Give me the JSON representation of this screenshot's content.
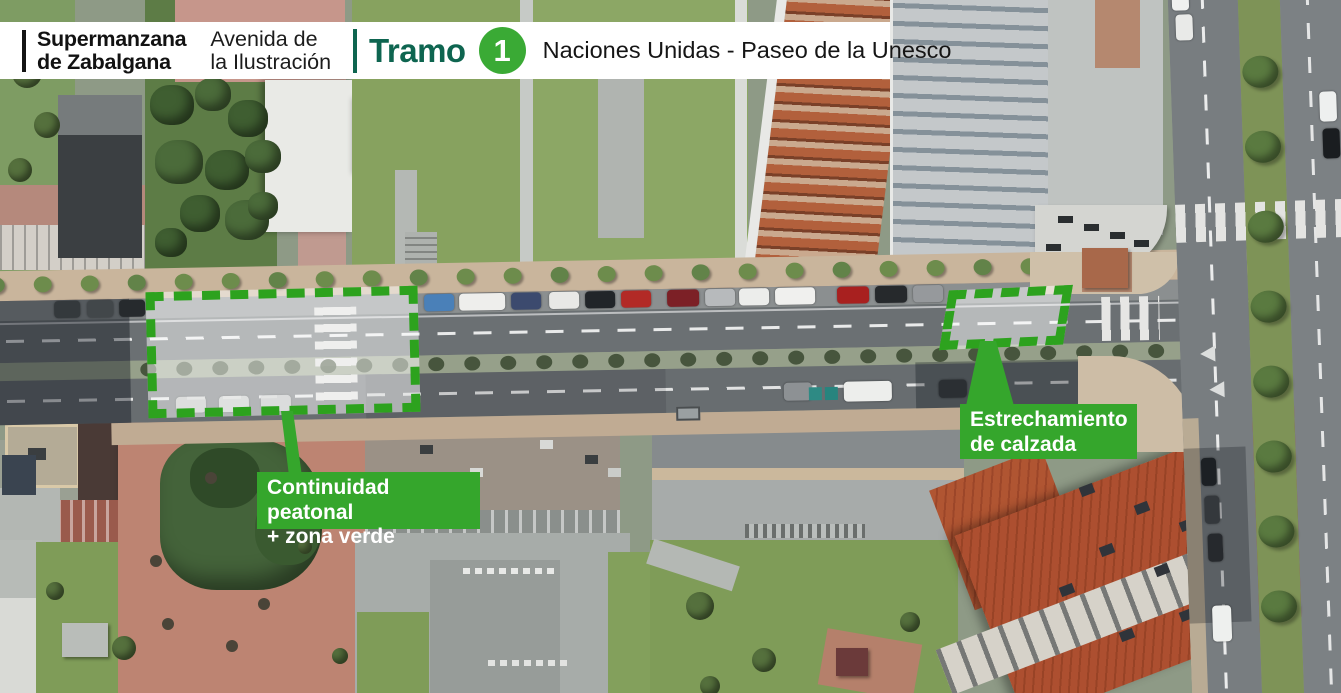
{
  "header": {
    "project_line1": "Supermanzana",
    "project_line2": "de Zabalgana",
    "street_line1": "Avenida de",
    "street_line2": "la Ilustración",
    "section_label": "Tramo",
    "section_number": "1",
    "section_range": "Naciones Unidas - Paseo de la Unesco"
  },
  "annotations": {
    "highlights": [
      {
        "id": "pedestrian-continuity",
        "label_line1": "Continuidad peatonal",
        "label_line2": "+ zona verde"
      },
      {
        "id": "road-narrowing",
        "label_line1": "Estrechamiento",
        "label_line2": "de calzada"
      }
    ]
  },
  "colors": {
    "accent_green": "#35a62c",
    "dash_green": "#2da21e",
    "brand_teal": "#0e6550",
    "badge_green": "#3aaa35",
    "label_text": "#ffffff"
  }
}
